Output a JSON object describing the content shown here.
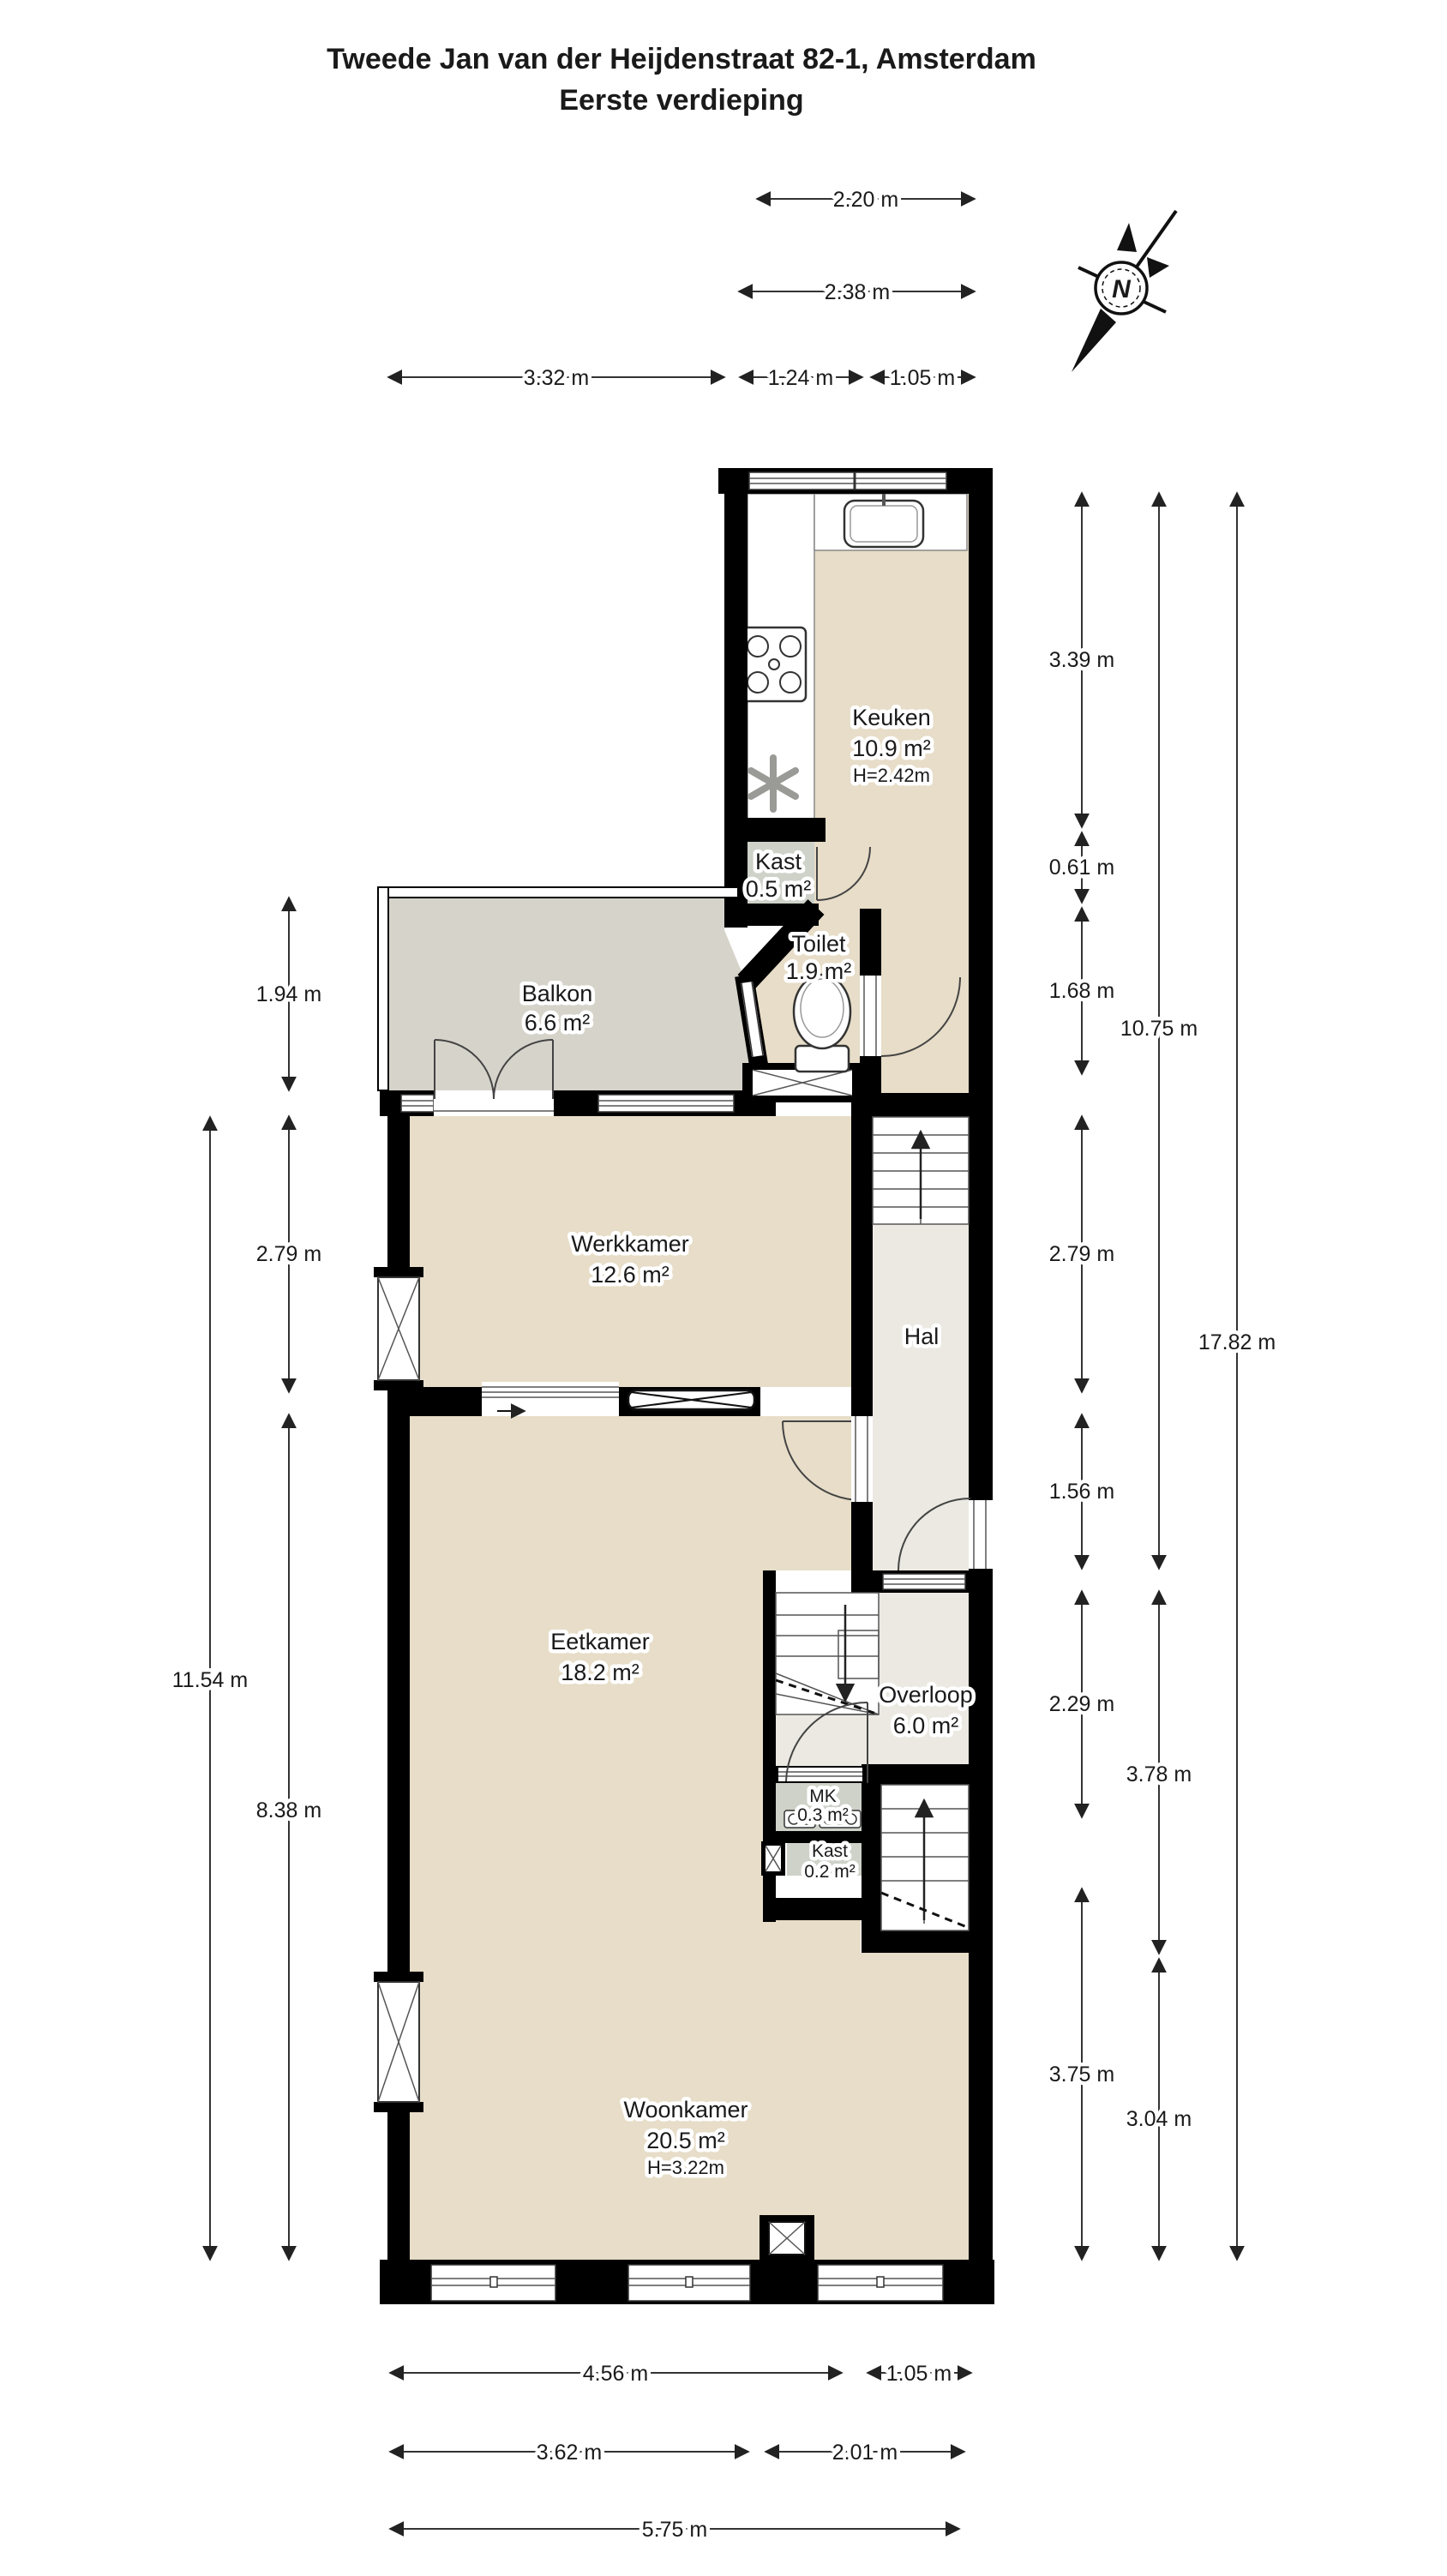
{
  "title": "Tweede Jan van der Heijdenstraat 82-1, Amsterdam",
  "subtitle": "Eerste verdieping",
  "compass": {
    "north_letter": "N"
  },
  "rooms": {
    "keuken": {
      "name": "Keuken",
      "area": "10.9 m²",
      "ceiling": "H=2.42m"
    },
    "kast_boven": {
      "name": "Kast",
      "area": "0.5 m²"
    },
    "toilet": {
      "name": "Toilet",
      "area": "1.9 m²"
    },
    "balkon": {
      "name": "Balkon",
      "area": "6.6 m²"
    },
    "werkkamer": {
      "name": "Werkkamer",
      "area": "12.6 m²"
    },
    "hal": {
      "name": "Hal"
    },
    "eetkamer": {
      "name": "Eetkamer",
      "area": "18.2 m²"
    },
    "overloop": {
      "name": "Overloop",
      "area": "6.0 m²"
    },
    "mk": {
      "name": "MK",
      "area": "0.3 m²"
    },
    "kast_onder": {
      "name": "Kast",
      "area": "0.2 m²"
    },
    "woonkamer": {
      "name": "Woonkamer",
      "area": "20.5 m²",
      "ceiling": "H=3.22m"
    }
  },
  "dimensions": {
    "top": [
      "2.20 m",
      "2.38 m",
      "3.32 m",
      "1.24 m",
      "1.05 m"
    ],
    "bottom": [
      "4.56 m",
      "1.05 m",
      "3.62 m",
      "2.01 m",
      "5.75 m"
    ],
    "left": [
      "1.94 m",
      "2.79 m",
      "8.38 m",
      "11.54 m"
    ],
    "right": [
      "3.39 m",
      "0.61 m",
      "1.68 m",
      "2.79 m",
      "1.56 m",
      "2.29 m",
      "3.75 m",
      "10.75 m",
      "3.78 m",
      "3.04 m",
      "17.82 m"
    ]
  },
  "colors": {
    "wall": "#000000",
    "room_floor": "#e7ddc8",
    "hall_floor": "#ebe9e2",
    "balcony_floor": "#d6d3ca",
    "closet_floor": "#ced2c9",
    "dimension_line": "#333333",
    "background": "#ffffff"
  }
}
